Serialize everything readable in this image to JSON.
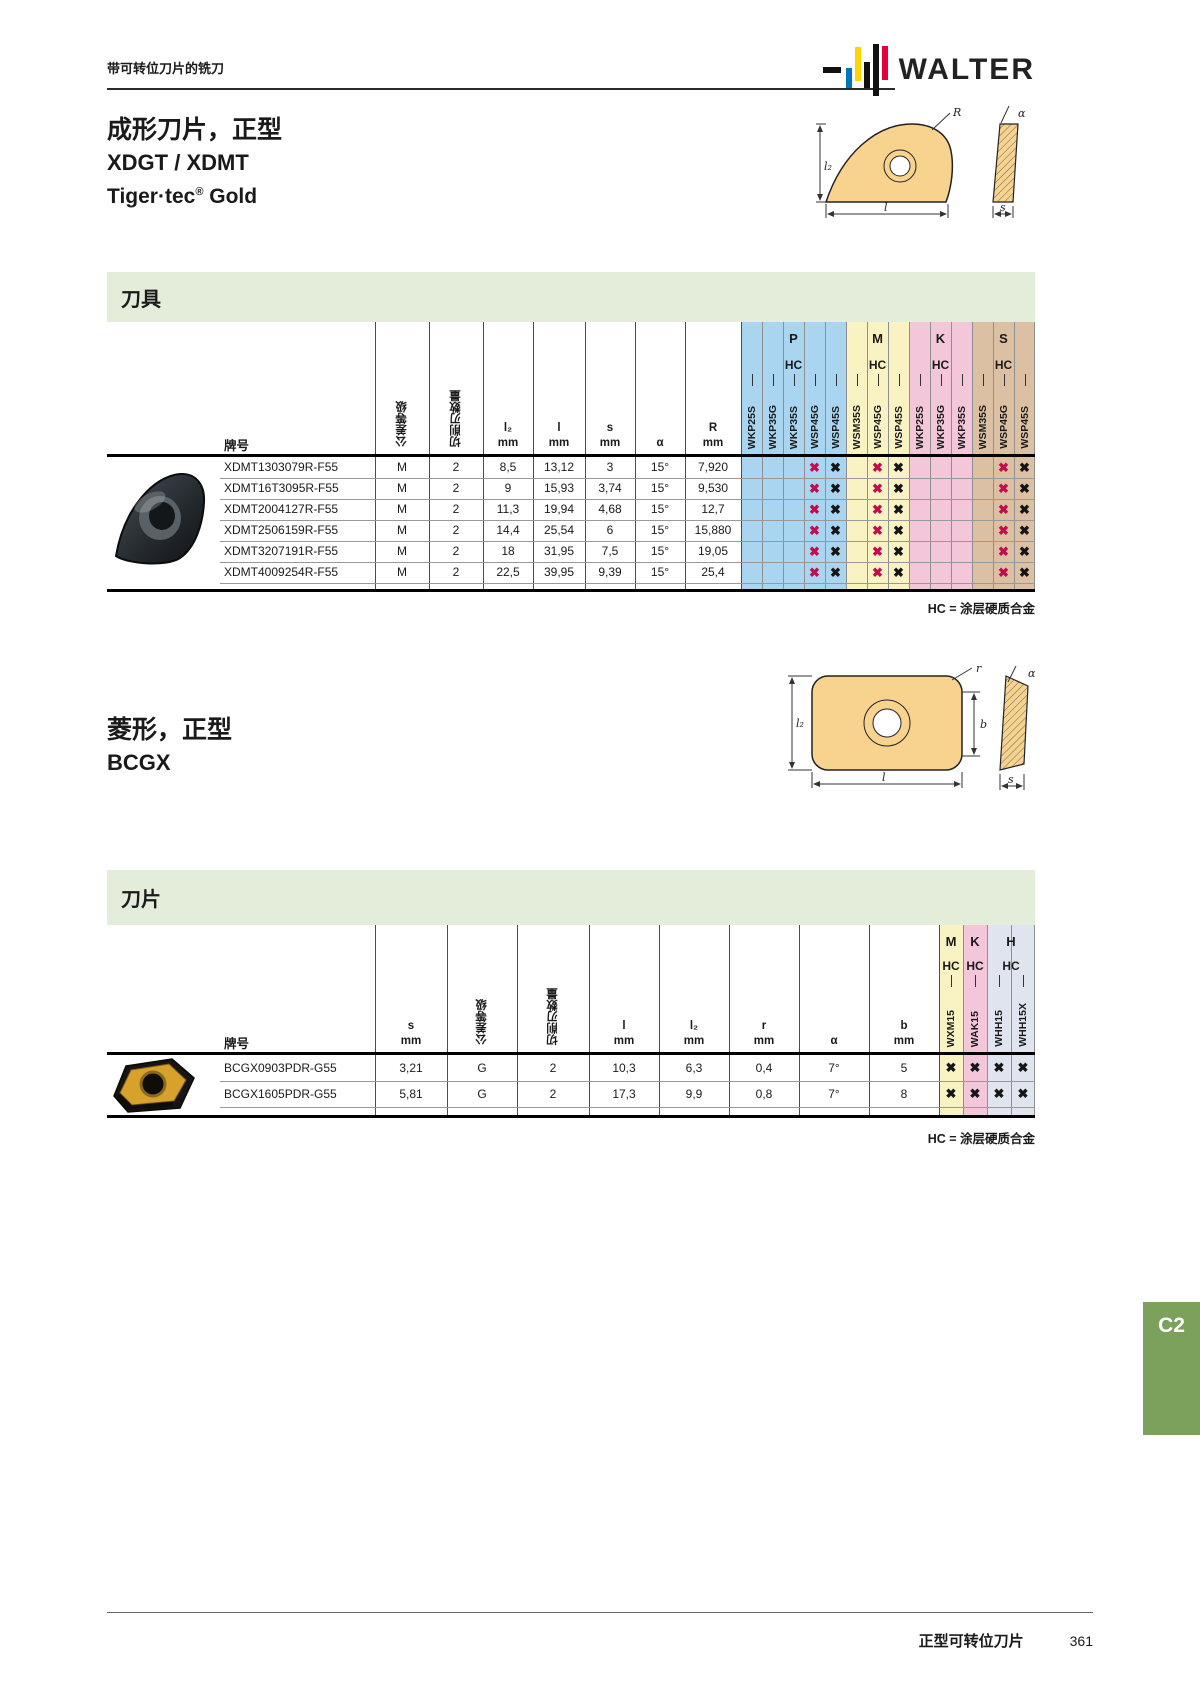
{
  "mark_colors": {
    "red": "#c30b4e",
    "black": "#151515"
  },
  "mark_glyph": "✖",
  "header": {
    "breadcrumb": "带可转位刀片的铣刀",
    "logo_text": "WALTER"
  },
  "footer": {
    "label": "正型可转位刀片",
    "page": "361"
  },
  "side_tab": "C2",
  "section1": {
    "title1": "成形刀片，正型",
    "title2": "XDGT / XDMT",
    "title3_pre": "Tiger·tec",
    "title3_sup": "®",
    "title3_post": " Gold",
    "band_title": "刀具",
    "note": "HC = 涂层硬质合金",
    "diagram": {
      "l2": "l₂",
      "R": "R",
      "alpha": "α",
      "l": "l",
      "s": "s"
    },
    "table": {
      "designation_header": "牌号",
      "pre_cols": [
        {
          "rot": "公差等级"
        },
        {
          "rot": "切削刃数量"
        },
        {
          "sym": "l₂",
          "unit": "mm"
        },
        {
          "sym": "l",
          "unit": "mm"
        },
        {
          "sym": "s",
          "unit": "mm"
        },
        {
          "sym": "α",
          "unit": ""
        },
        {
          "sym": "R",
          "unit": "mm"
        }
      ],
      "grade_groups": [
        {
          "letter": "P",
          "coating": "HC",
          "color": "#a9d5f0",
          "grades": [
            "WKP25S",
            "WKP35G",
            "WKP35S",
            "WSP45G",
            "WSP45S"
          ]
        },
        {
          "letter": "M",
          "coating": "HC",
          "color": "#f9f3c3",
          "grades": [
            "WSM35S",
            "WSP45G",
            "WSP45S"
          ]
        },
        {
          "letter": "K",
          "coating": "HC",
          "color": "#f3c6d9",
          "grades": [
            "WKP25S",
            "WKP35G",
            "WKP35S"
          ]
        },
        {
          "letter": "S",
          "coating": "HC",
          "color": "#dbc0a4",
          "grades": [
            "WSM35S",
            "WSP45G",
            "WSP45S"
          ]
        }
      ],
      "rows": [
        {
          "name": "XDMT1303079R-F55",
          "cells": [
            "M",
            "2",
            "8,5",
            "13,12",
            "3",
            "15°",
            "7,920"
          ],
          "marks": [
            "",
            "",
            "",
            "red",
            "black",
            "",
            "red",
            "black",
            "",
            "",
            "",
            "",
            "red",
            "black"
          ]
        },
        {
          "name": "XDMT16T3095R-F55",
          "cells": [
            "M",
            "2",
            "9",
            "15,93",
            "3,74",
            "15°",
            "9,530"
          ],
          "marks": [
            "",
            "",
            "",
            "red",
            "black",
            "",
            "red",
            "black",
            "",
            "",
            "",
            "",
            "red",
            "black"
          ]
        },
        {
          "name": "XDMT2004127R-F55",
          "cells": [
            "M",
            "2",
            "11,3",
            "19,94",
            "4,68",
            "15°",
            "12,7"
          ],
          "marks": [
            "",
            "",
            "",
            "red",
            "black",
            "",
            "red",
            "black",
            "",
            "",
            "",
            "",
            "red",
            "black"
          ]
        },
        {
          "name": "XDMT2506159R-F55",
          "cells": [
            "M",
            "2",
            "14,4",
            "25,54",
            "6",
            "15°",
            "15,880"
          ],
          "marks": [
            "",
            "",
            "",
            "red",
            "black",
            "",
            "red",
            "black",
            "",
            "",
            "",
            "",
            "red",
            "black"
          ]
        },
        {
          "name": "XDMT3207191R-F55",
          "cells": [
            "M",
            "2",
            "18",
            "31,95",
            "7,5",
            "15°",
            "19,05"
          ],
          "marks": [
            "",
            "",
            "",
            "red",
            "black",
            "",
            "red",
            "black",
            "",
            "",
            "",
            "",
            "red",
            "black"
          ]
        },
        {
          "name": "XDMT4009254R-F55",
          "cells": [
            "M",
            "2",
            "22,5",
            "39,95",
            "9,39",
            "15°",
            "25,4"
          ],
          "marks": [
            "",
            "",
            "",
            "red",
            "black",
            "",
            "red",
            "black",
            "",
            "",
            "",
            "",
            "red",
            "black"
          ]
        }
      ]
    }
  },
  "section2": {
    "title1": "菱形，正型",
    "title2": "BCGX",
    "band_title": "刀片",
    "note": "HC = 涂层硬质合金",
    "diagram": {
      "l2": "l₂",
      "r": "r",
      "b": "b",
      "alpha": "α",
      "l": "l",
      "s": "s"
    },
    "table": {
      "designation_header": "牌号",
      "pre_cols": [
        {
          "sym": "s",
          "unit": "mm"
        },
        {
          "rot": "公差等级"
        },
        {
          "rot": "切削刃数量"
        },
        {
          "sym": "l",
          "unit": "mm"
        },
        {
          "sym": "l₂",
          "unit": "mm"
        },
        {
          "sym": "r",
          "unit": "mm"
        },
        {
          "sym": "α",
          "unit": ""
        },
        {
          "sym": "b",
          "unit": "mm"
        }
      ],
      "grade_groups": [
        {
          "letter": "M",
          "coating": "HC",
          "color": "#f9f3c3",
          "grades": [
            "WXM15"
          ]
        },
        {
          "letter": "K",
          "coating": "HC",
          "color": "#f3c6d9",
          "grades": [
            "WAK15"
          ]
        },
        {
          "letter": "H",
          "coating": "HC",
          "color": "#dfe4ee",
          "grades": [
            "WHH15",
            "WHH15X"
          ]
        }
      ],
      "rows": [
        {
          "name": "BCGX0903PDR-G55",
          "cells": [
            "3,21",
            "G",
            "2",
            "10,3",
            "6,3",
            "0,4",
            "7°",
            "5"
          ],
          "marks": [
            "black",
            "black",
            "black",
            "black"
          ]
        },
        {
          "name": "BCGX1605PDR-G55",
          "cells": [
            "5,81",
            "G",
            "2",
            "17,3",
            "9,9",
            "0,8",
            "7°",
            "8"
          ],
          "marks": [
            "black",
            "black",
            "black",
            "black"
          ]
        }
      ]
    }
  }
}
